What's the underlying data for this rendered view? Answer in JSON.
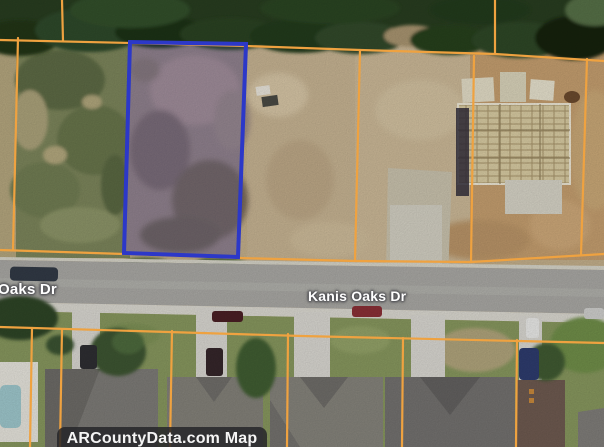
{
  "map": {
    "street_labels": [
      {
        "text": "Oaks Dr"
      },
      {
        "text": "Kanis Oaks Dr"
      }
    ],
    "attribution": "ARCountyData.com Map",
    "colors": {
      "parcel_boundary_line": "#efa240",
      "selected_parcel_outline": "#2c38c8",
      "selected_parcel_fill": "rgba(90,100,220,0.13)"
    },
    "view": "aerial-satellite"
  }
}
